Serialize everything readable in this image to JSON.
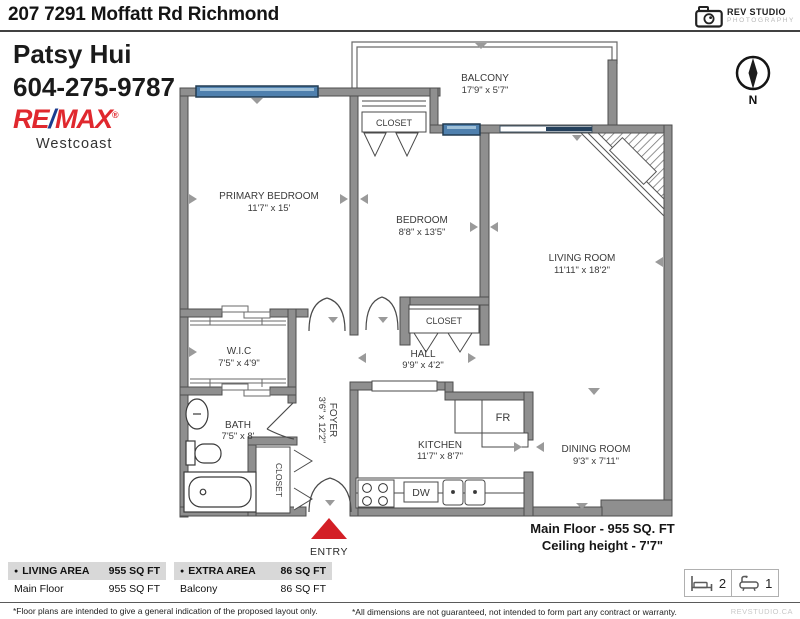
{
  "header": {
    "address": "207 7291 Moffatt Rd Richmond"
  },
  "agent": {
    "name": "Patsy Hui",
    "phone": "604-275-9787",
    "brand_re": "RE",
    "brand_slash": "/",
    "brand_max": "MAX",
    "brand_reg": "®",
    "office": "Westcoast"
  },
  "studio": {
    "name": "REV STUDIO",
    "tagline": "PHOTOGRAPHY",
    "watermark": "REVSTUDIO.CA"
  },
  "compass": {
    "n": "N"
  },
  "rooms": {
    "balcony": {
      "name": "BALCONY",
      "dims": "17'9\" x 5'7\""
    },
    "primary_bedroom": {
      "name": "PRIMARY BEDROOM",
      "dims": "11'7\" x 15'"
    },
    "bedroom": {
      "name": "BEDROOM",
      "dims": "8'8\" x 13'5\""
    },
    "living_room": {
      "name": "LIVING ROOM",
      "dims": "11'11\" x 18'2\""
    },
    "dining_room": {
      "name": "DINING ROOM",
      "dims": "9'3\" x 7'11\""
    },
    "kitchen": {
      "name": "KITCHEN",
      "dims": "11'7\" x 8'7\""
    },
    "hall": {
      "name": "HALL",
      "dims": "9'9\" x 4'2\""
    },
    "foyer": {
      "name": "FOYER",
      "dims": "3'6\" x 12'2\""
    },
    "wic": {
      "name": "W.I.C",
      "dims": "7'5\" x 4'9\""
    },
    "bath": {
      "name": "BATH",
      "dims": "7'5\" x 8'"
    },
    "closet_primary": "CLOSET",
    "closet_hall": "CLOSET",
    "closet_entry": "CLOSET"
  },
  "labels": {
    "fridge": "FR",
    "dishwasher": "DW",
    "entry": "ENTRY"
  },
  "floor_summary": {
    "area": "Main Floor - 955 SQ. FT",
    "ceiling": "Ceiling height - 7'7\""
  },
  "legend": {
    "bullet": "●",
    "living": {
      "header": "LIVING AREA",
      "header_value": "955 SQ FT",
      "row_label": "Main Floor",
      "row_value": "955 SQ FT"
    },
    "extra": {
      "header": "EXTRA AREA",
      "header_value": "86 SQ FT",
      "row_label": "Balcony",
      "row_value": "86 SQ FT"
    }
  },
  "stats": {
    "beds": "2",
    "baths": "1"
  },
  "footnotes": {
    "left": "*Floor plans are intended to give a general indication of the proposed layout only.",
    "right": "*All dimensions are not guaranteed, not intended to form part any contract or warranty."
  },
  "colors": {
    "wall": "#8F8F8F",
    "window": "#4F80AE",
    "accent_red": "#D31F26",
    "remax_red": "#E0282E",
    "remax_blue": "#1B3D8F"
  }
}
